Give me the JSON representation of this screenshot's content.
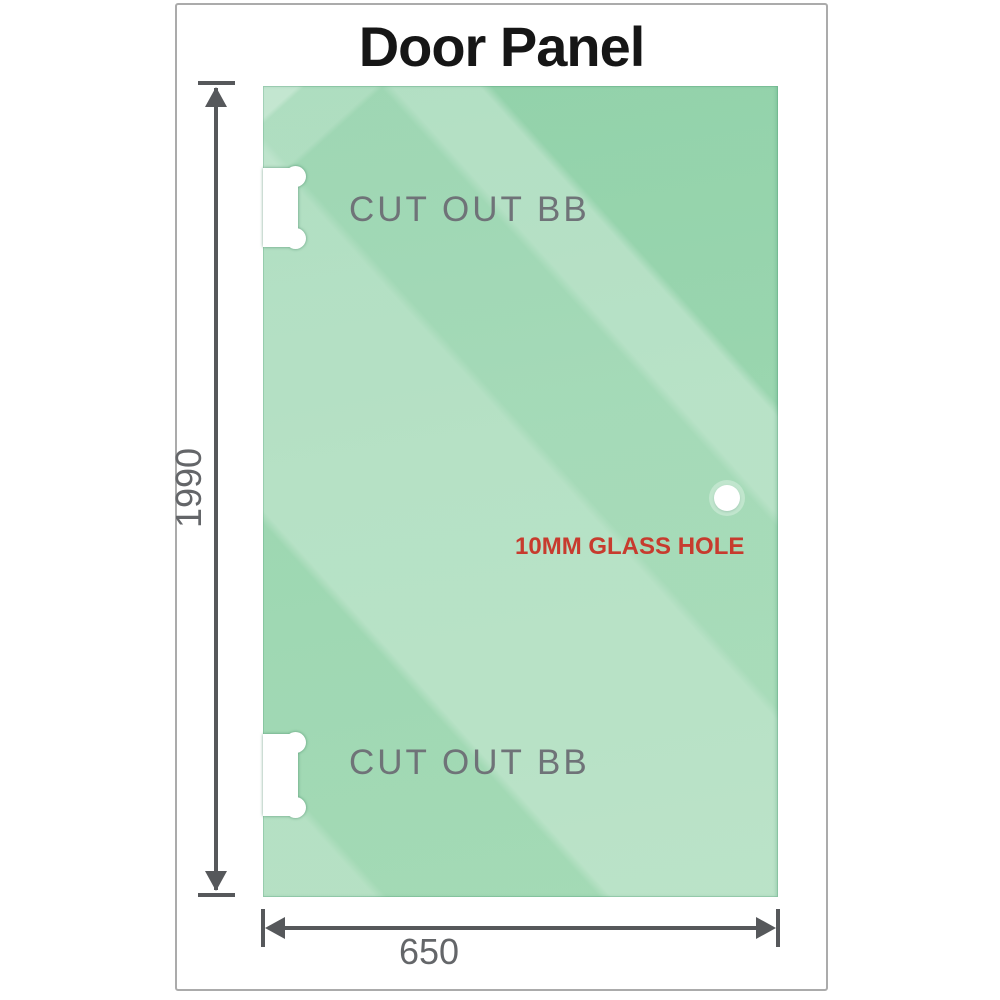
{
  "title": "Door Panel",
  "dimensions": {
    "height": "1990",
    "width": "650"
  },
  "cutouts": {
    "top_label": "CUT OUT BB",
    "bottom_label": "CUT OUT BB"
  },
  "hole": {
    "label": "10MM GLASS HOLE"
  },
  "colors": {
    "glass_green": "#93d2a9",
    "glass_green_dark": "#82c99b",
    "glass_highlight": "#bfe4ca",
    "dimension_gray": "#56585b",
    "label_gray": "#6f7378",
    "dim_label_gray": "#646669",
    "hole_label_red": "#c73b2e",
    "title_black": "#161616",
    "frame_border": "#ababab"
  }
}
